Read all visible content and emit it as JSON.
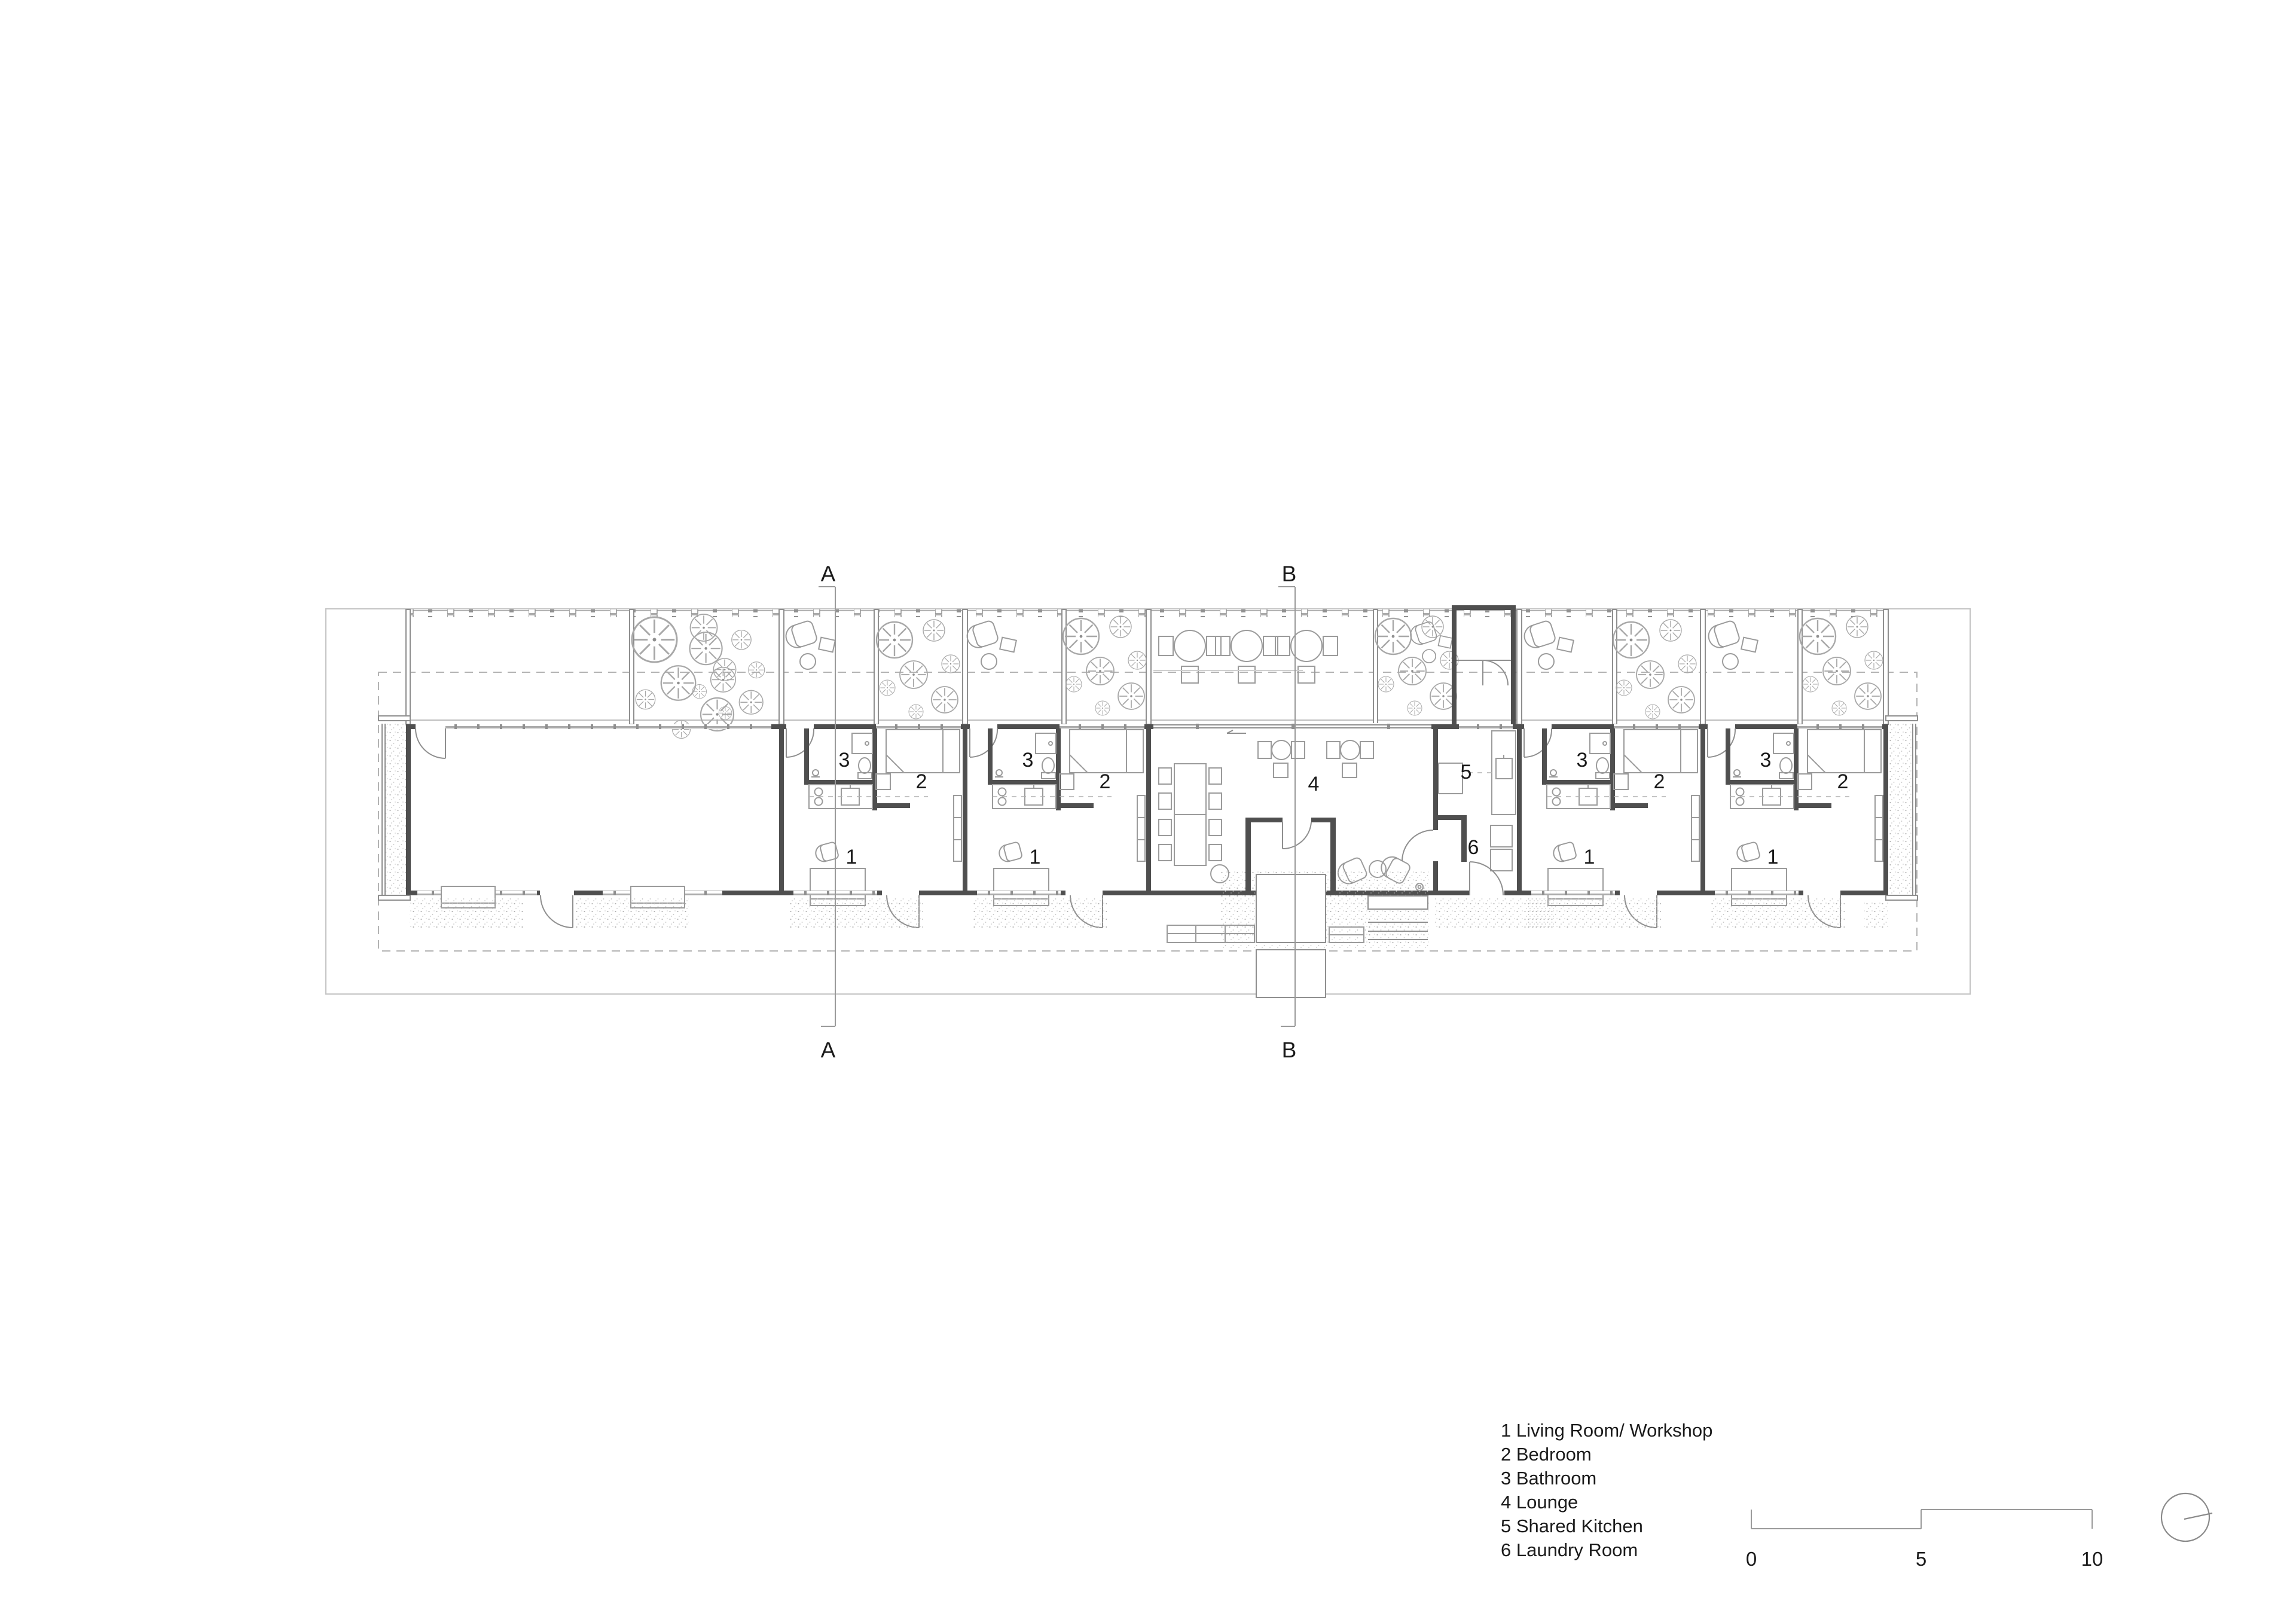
{
  "drawing": {
    "type": "architectural-floor-plan",
    "background": "#ffffff",
    "colors": {
      "wall": "#4f4f4f",
      "thin_line": "#8f8f8f",
      "light_line": "#bdbdbd",
      "text": "#1a1a1a"
    }
  },
  "section_markers": {
    "a": "A",
    "b": "B"
  },
  "room_labels": {
    "living": "1",
    "bedroom": "2",
    "bathroom": "3",
    "lounge": "4",
    "kitchen": "5",
    "laundry": "6"
  },
  "legend": {
    "items": [
      "1 Living Room/ Workshop",
      "2 Bedroom",
      "3 Bathroom",
      "4 Lounge",
      "5 Shared Kitchen",
      "6 Laundry Room"
    ]
  },
  "scale_bar": {
    "labels": [
      "0",
      "5",
      "10"
    ]
  },
  "icons": {
    "north_indicator": "north-circle-needle"
  }
}
